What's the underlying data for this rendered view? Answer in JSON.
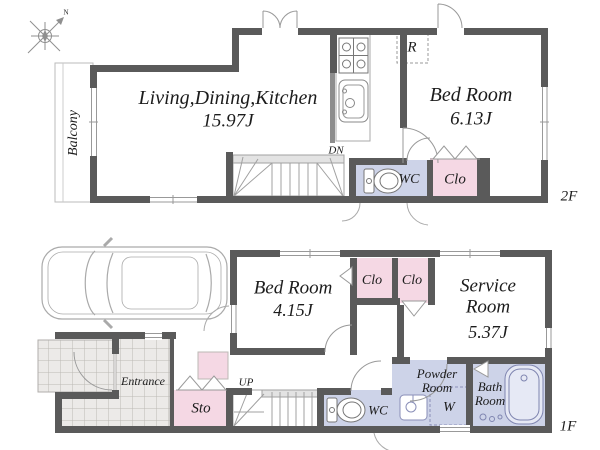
{
  "compass": {
    "north_label": "N"
  },
  "floor2": {
    "tag": "2F",
    "balcony_label": "Balcony",
    "ldk": {
      "name": "Living,Dining,Kitchen",
      "size": "15.97J"
    },
    "bedroom": {
      "name": "Bed Room",
      "size": "6.13J"
    },
    "refrigerator_label": "R",
    "stairs_label": "DN",
    "wc_label": "WC",
    "closet_label": "Clo"
  },
  "floor1": {
    "tag": "1F",
    "bedroom": {
      "name": "Bed Room",
      "size": "4.15J"
    },
    "closet1_label": "Clo",
    "closet2_label": "Clo",
    "service_room": {
      "name": "Service Room",
      "size": "5.37J"
    },
    "entrance_label": "Entrance",
    "storage_label": "Sto",
    "stairs_label": "UP",
    "wc_label": "WC",
    "powder_room": {
      "name": "Powder Room",
      "washer_label": "W"
    },
    "bath_room_label": "Bath Room"
  },
  "colors": {
    "wall": "#5a5a5a",
    "closet_pink": "#f5d8e4",
    "wet_room_lavender": "#cdd3e8",
    "tile_floor": "#eceae8",
    "thin_line": "#999999"
  }
}
